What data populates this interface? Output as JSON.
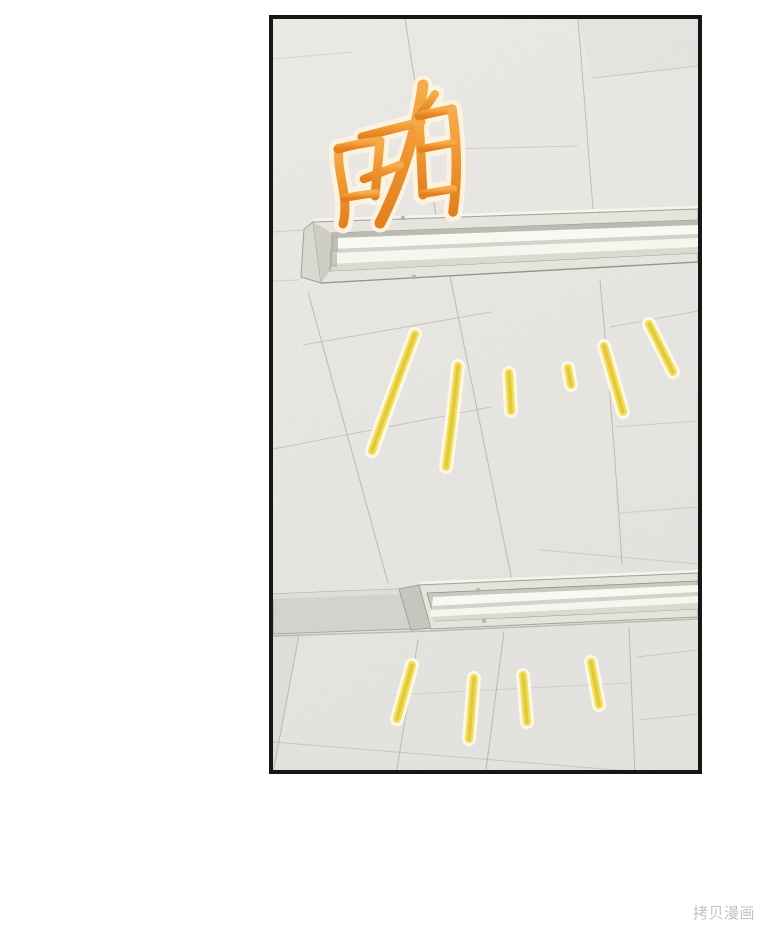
{
  "page": {
    "background_color": "#FFFFFF"
  },
  "panel": {
    "description": "Manhwa panel: office ceiling seen from below with two recessed fluorescent light fixtures flicking on",
    "border_color": "#161616",
    "ceiling_color": "#EBEAE6",
    "seam_color": "#B3B1A9"
  },
  "sfx": {
    "text": "啪",
    "fill_top": "#F6AC48",
    "fill_bottom": "#E2801C",
    "outline_color": "#FBF2E0"
  },
  "light_rays": {
    "core_color": "#E3C93A",
    "mid_color": "#F2DF55",
    "halo_color": "#FBF8E8",
    "upper_group_count": 6,
    "lower_group_count": 4
  },
  "fixtures": {
    "count": 2,
    "frame_color": "#E7E6DD",
    "tube_color": "#FBFBF5"
  },
  "watermark": {
    "text": "拷贝漫画",
    "color": "#BDBCB8"
  }
}
